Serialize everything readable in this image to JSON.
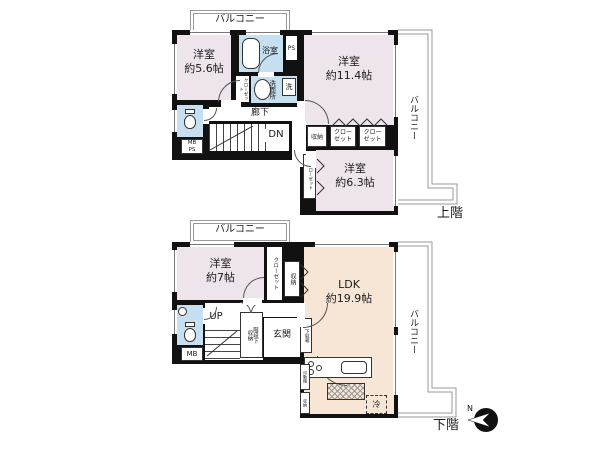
{
  "palette": {
    "bedroom_fill": "#EDE4EC",
    "ldk_fill": "#F7E6D6",
    "wet_area_fill": "#C6E0F2",
    "wall": "#111111",
    "balcony_outline": "#999999"
  },
  "upper_floor": {
    "balcony_top_label": "バルコニー",
    "balcony_right_label": "バルコニー",
    "bedroom1_label": "洋室\n約5.6帖",
    "bathroom_label": "浴室",
    "ps_label": "PS",
    "washroom_label": "洗面所",
    "washer_label": "洗",
    "closet_small_label": "クローゼット",
    "bedroom2_label": "洋室\n約11.4帖",
    "hallway_label": "廊下",
    "stairs_label": "DN",
    "meter_box_label": "MB\nPS",
    "storage_label": "収納",
    "closet1_label": "クロー\nゼット",
    "closet2_label": "クロー\nゼット",
    "closet3_label": "クローゼット",
    "bedroom3_label": "洋室\n約6.3帖",
    "floor_label": "上階"
  },
  "lower_floor": {
    "balcony_top_label": "バルコニー",
    "balcony_right_label": "バルコニー",
    "bedroom_label": "洋室\n約7帖",
    "closet_label": "クローゼット",
    "storage_label": "収納",
    "ldk_label": "LDK\n約19.9帖",
    "stairs_label": "UP",
    "under_stairs_storage_label": "階段下\n収納",
    "entrance_label": "玄関",
    "shoe_cabinet_label": "下駄箱",
    "meter_box_label": "MB",
    "fridge_label": "冷",
    "movable_shelf_label": "可動棚",
    "shelf2_label": "収納",
    "floor_label": "下階",
    "compass_label": "N"
  }
}
